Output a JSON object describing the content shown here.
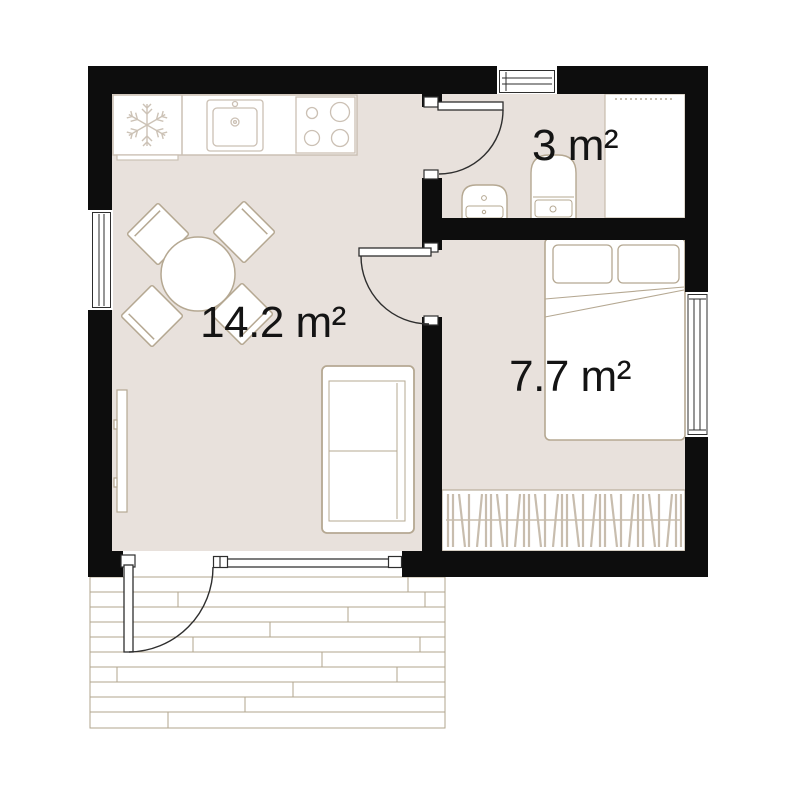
{
  "plan": {
    "type": "apartment-floor-plan",
    "rooms": [
      {
        "name": "living-room-kitchen",
        "area_label": "14.2 m²"
      },
      {
        "name": "bathroom",
        "area_label": "3 m²"
      },
      {
        "name": "bedroom",
        "area_label": "7.7 m²"
      }
    ],
    "fixtures": [
      "fridge-snowflake-icon",
      "kitchen-sink",
      "stove-burners",
      "dining-table",
      "dining-chairs",
      "sofa",
      "tv-panel",
      "double-bed",
      "pillows",
      "wardrobe-clothes-rail",
      "washbasin",
      "toilet",
      "shower",
      "wood-deck",
      "entrance-door",
      "bathroom-door",
      "bedroom-door",
      "windows"
    ],
    "colors": {
      "background": "#ffffff",
      "wall": "#0d0d0d",
      "floor": "#e8e1dc",
      "furniture_outline": "#b5a892",
      "kitchen_outline": "#cbc0b4",
      "deck_line": "#b2a58e",
      "clothes_hatch": "#c8bdae",
      "dark_line": "#2e2e2e",
      "label_text": "#141414"
    }
  }
}
